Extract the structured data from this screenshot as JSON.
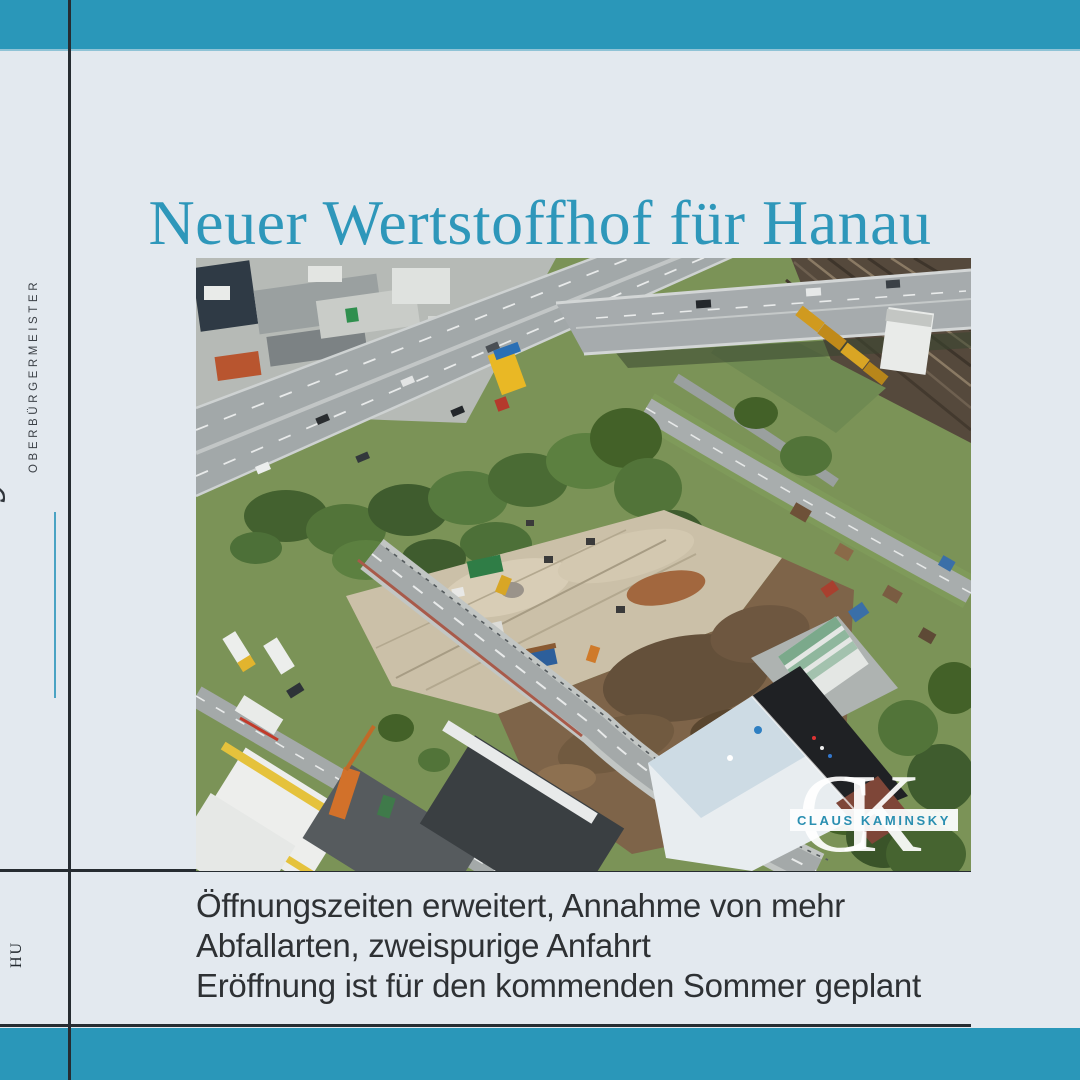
{
  "page": {
    "title": "Neuer Wertstoffhof für Hanau"
  },
  "sidebar": {
    "signature": "Claus Kaminsky",
    "role": "OBERBÜRGERMEISTER",
    "footer_mark": "HU"
  },
  "photo": {
    "description": "aerial-view-of-construction-site-with-highway-bridge-railway-and-cleared-lot",
    "watermark": {
      "initials": "CK",
      "name": "CLAUS KAMINSKY"
    }
  },
  "caption": {
    "lines": [
      "Öffnungszeiten erweitert, Annahme von mehr",
      "Abfallarten, zweispurige Anfahrt",
      "Eröffnung ist für den kommenden Sommer geplant"
    ]
  },
  "colors": {
    "teal": "#2a97b9",
    "background": "#e3e9ef",
    "title_teal": "#2e97ba",
    "body_text": "#2e3134",
    "rule": "#262c31",
    "watermark_text": "#2a8fb1",
    "signature_underline": "#4aa3c3"
  }
}
